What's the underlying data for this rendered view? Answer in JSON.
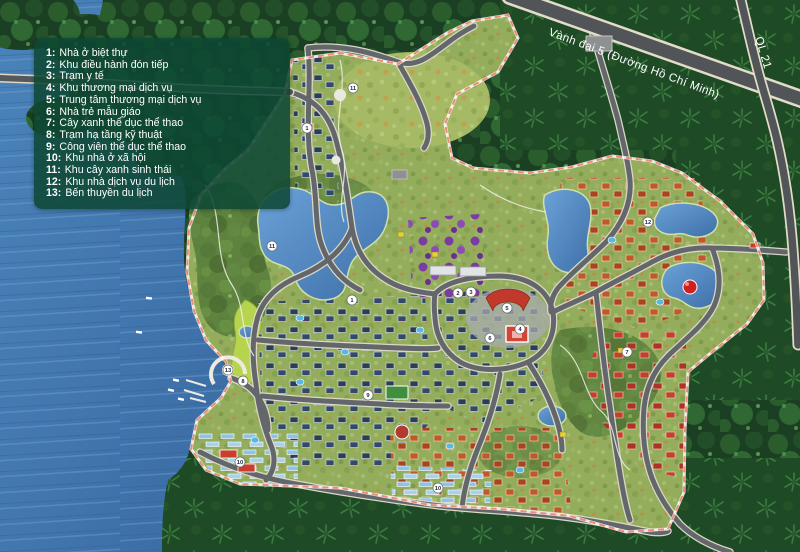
{
  "map": {
    "name": "Resort master plan map",
    "legend": {
      "items": [
        {
          "num": "1:",
          "label": "Nhà ở biệt thự"
        },
        {
          "num": "2:",
          "label": "Khu điều hành đón tiếp"
        },
        {
          "num": "3:",
          "label": "Trạm y tế"
        },
        {
          "num": "4:",
          "label": "Khu thương mại dịch vụ"
        },
        {
          "num": "5:",
          "label": "Trung tâm thương mại dịch vụ"
        },
        {
          "num": "6:",
          "label": "Nhà trẻ mẫu giáo"
        },
        {
          "num": "7:",
          "label": "Cây xanh thể dục thể thao"
        },
        {
          "num": "8:",
          "label": "Trạm hạ tầng kỹ thuật"
        },
        {
          "num": "9:",
          "label": "Công viên thể dục thể thao"
        },
        {
          "num": "10:",
          "label": "Khu nhà ở xã hội"
        },
        {
          "num": "11:",
          "label": "Khu cây xanh sinh thái"
        },
        {
          "num": "12:",
          "label": "Khu nhà dịch vụ du lịch"
        },
        {
          "num": "13:",
          "label": "Bến thuyền du lịch"
        }
      ]
    },
    "roads": {
      "ring_road_label": "Vành đai 5 (Đường Hồ Chí Minh)",
      "highway_label": "QL 21"
    },
    "markers": [
      {
        "n": "1"
      },
      {
        "n": "1"
      },
      {
        "n": "2"
      },
      {
        "n": "3"
      },
      {
        "n": "4"
      },
      {
        "n": "5"
      },
      {
        "n": "6"
      },
      {
        "n": "7"
      },
      {
        "n": "8"
      },
      {
        "n": "9"
      },
      {
        "n": "10"
      },
      {
        "n": "10"
      },
      {
        "n": "11"
      },
      {
        "n": "11"
      },
      {
        "n": "12"
      },
      {
        "n": "13"
      }
    ],
    "colors": {
      "water": "#3f77ae",
      "forest": "#1d4526",
      "site_green": "#93ad5d",
      "road": "#56595d",
      "boundary": "#ef8a75",
      "lake": "#4f86c4",
      "roof_navy": "#2c3e57",
      "roof_red": "#b03226",
      "roof_orange": "#c0582a",
      "social_housing": "#8fc3e4",
      "eco_purple": "#7c3ba3",
      "legend_bg": "#0e4834",
      "marker_bg": "#ffffff"
    }
  }
}
